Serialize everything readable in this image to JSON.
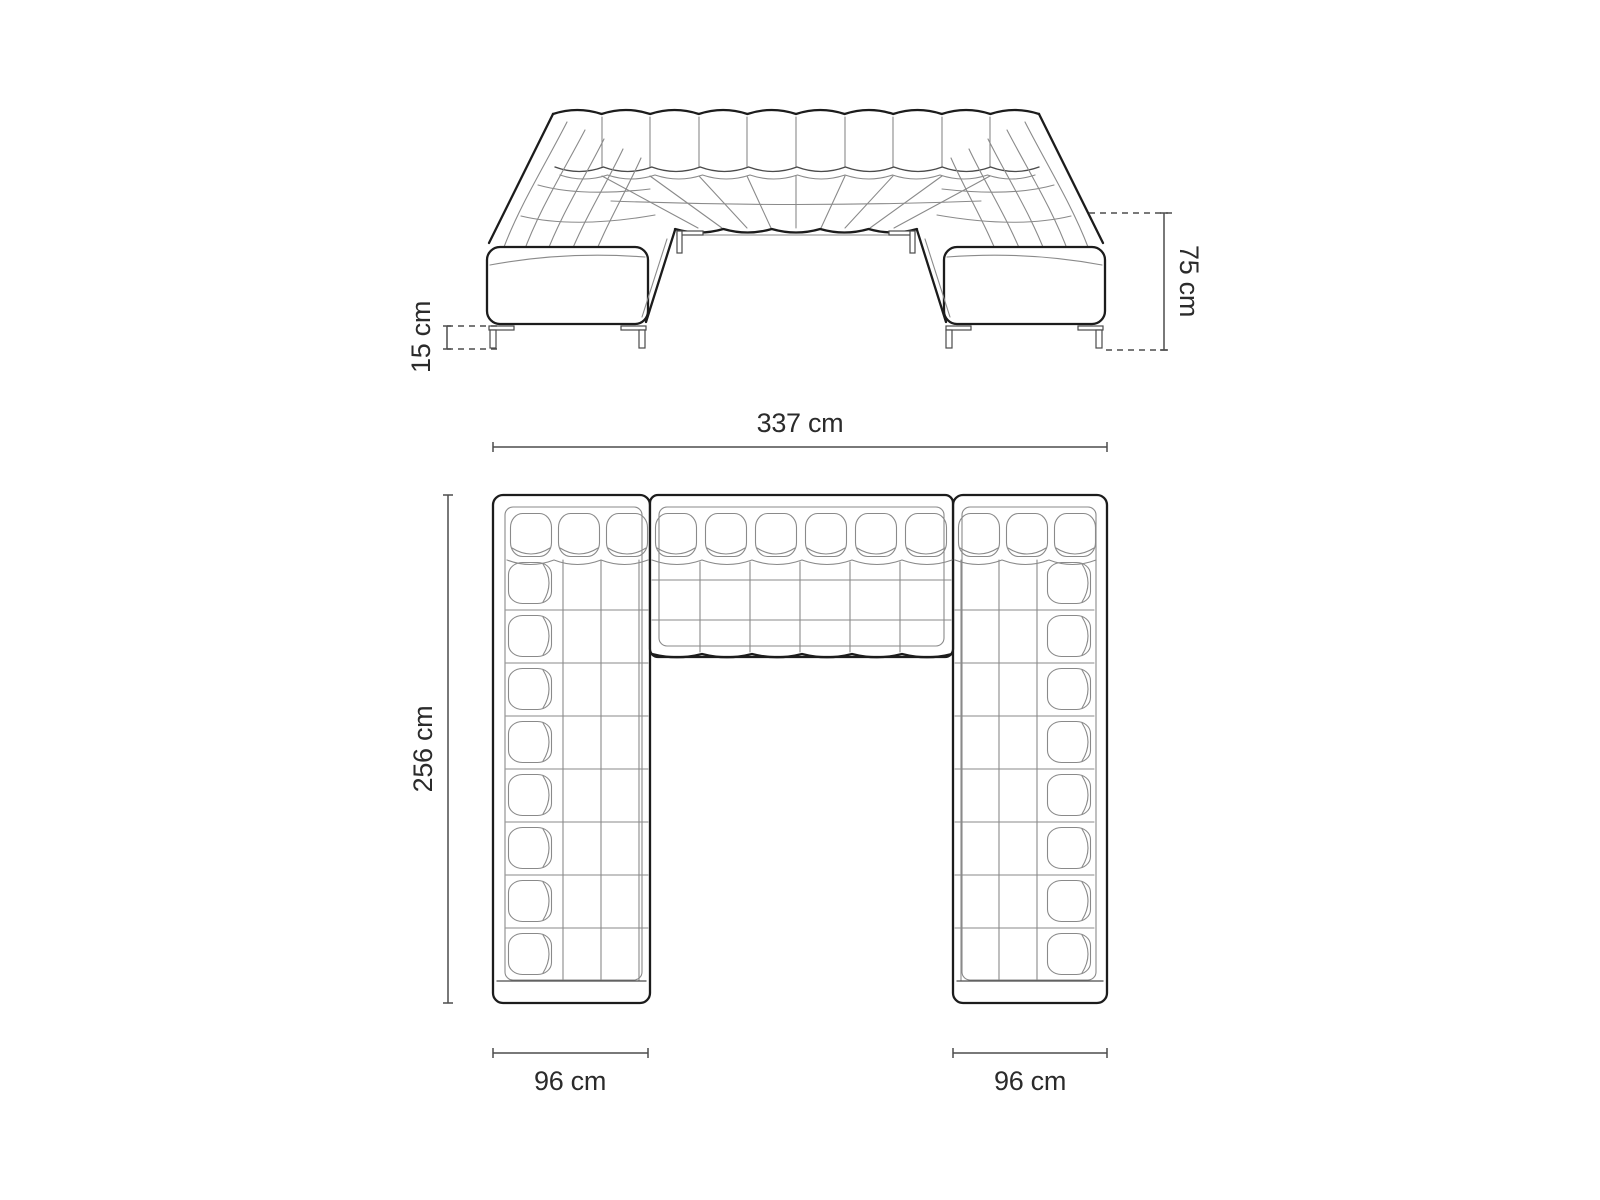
{
  "diagram": {
    "subject": "u-shaped-sectional-sofa",
    "views": {
      "front_elevation": "front view with height dimensions",
      "top_plan": "top-down view with width and depth dimensions"
    }
  },
  "dimensions": {
    "leg_height": {
      "label": "15 cm",
      "value": 15,
      "unit": "cm"
    },
    "overall_height": {
      "label": "75 cm",
      "value": 75,
      "unit": "cm"
    },
    "overall_width": {
      "label": "337 cm",
      "value": 337,
      "unit": "cm"
    },
    "overall_depth": {
      "label": "256 cm",
      "value": 256,
      "unit": "cm"
    },
    "left_arm_width": {
      "label": "96 cm",
      "value": 96,
      "unit": "cm"
    },
    "right_arm_width": {
      "label": "96 cm",
      "value": 96,
      "unit": "cm"
    }
  },
  "colors": {
    "line_bold": "#1c1c1c",
    "line_thin": "#8a8a8a",
    "dimension_line": "#4d4d4d",
    "label_text": "#2b2b2b",
    "background": "#ffffff"
  }
}
